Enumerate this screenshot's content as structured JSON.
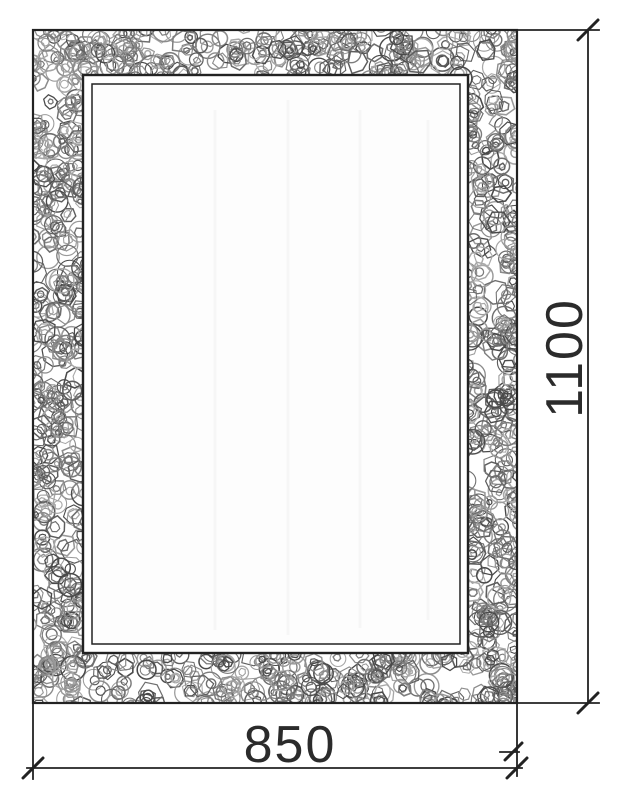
{
  "drawing": {
    "width_dimension": "850",
    "height_dimension": "1100",
    "colors": {
      "background": "#ffffff",
      "line": "#222222",
      "text": "#2b2b2b",
      "texture_greys": [
        "#4a4a4a",
        "#5e5e5e",
        "#6f6f6f",
        "#7d7d7d",
        "#8c8c8c",
        "#9a9a9a",
        "#a8a8a8"
      ]
    }
  }
}
